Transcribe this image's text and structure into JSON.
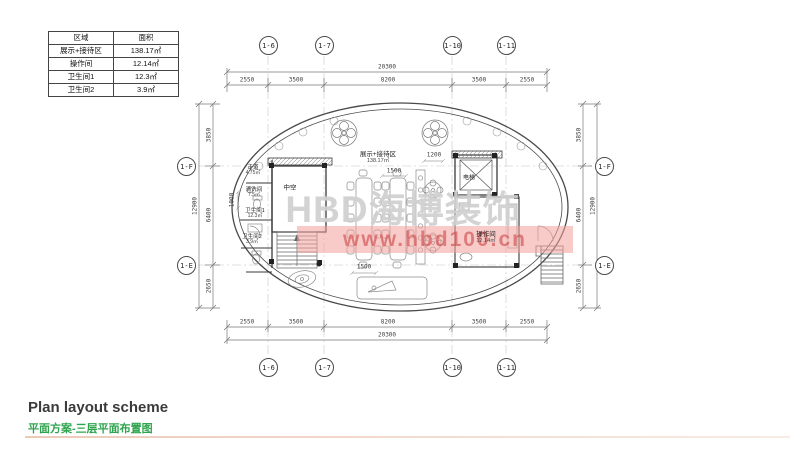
{
  "area_table": {
    "headers": [
      "区域",
      "面积"
    ],
    "rows": [
      {
        "name": "展示+接待区",
        "area": "138.17㎡"
      },
      {
        "name": "操作间",
        "area": "12.14㎡"
      },
      {
        "name": "卫生间1",
        "area": "12.3㎡"
      },
      {
        "name": "卫生间2",
        "area": "3.9㎡"
      }
    ]
  },
  "grid_bubbles": {
    "top": [
      "1-6",
      "1-7",
      "1-10",
      "1-11"
    ],
    "bottom": [
      "1-6",
      "1-7",
      "1-10",
      "1-11"
    ],
    "left": [
      "1-F",
      "1-E"
    ],
    "right": [
      "1-F",
      "1-E"
    ]
  },
  "dimensions": {
    "top_total": "20300",
    "top_chain": [
      "2550",
      "3500",
      "8200",
      "3500",
      "2550"
    ],
    "bottom_chain": [
      "2550",
      "3500",
      "8200",
      "3500",
      "2550"
    ],
    "bottom_total": "20300",
    "left_chain": [
      "3850",
      "6400",
      "2650"
    ],
    "left_total": "12900",
    "right_chain": [
      "3850",
      "6400",
      "2650"
    ],
    "right_total": "12900",
    "interior": {
      "table_top": "1500",
      "table_bottom": "1500",
      "elevator_front": "1200",
      "left_bay": "1000"
    }
  },
  "rooms": {
    "exhibition": {
      "name": "展示+接待区",
      "area": "138.17㎡"
    },
    "void": {
      "name": "中空"
    },
    "elevator": {
      "name": "电梯"
    },
    "operation": {
      "name": "操作间",
      "area": "12.14㎡"
    },
    "corridor": {
      "name": "走道",
      "area": "4.75㎡"
    },
    "cleaning": {
      "name": "清洗间",
      "area": "7.5㎡"
    },
    "toilet1": {
      "name": "卫生间1",
      "area": "12.3㎡"
    },
    "toilet2": {
      "name": "卫生间2",
      "area": "3.9㎡"
    }
  },
  "watermark": {
    "brand": "HBD海博装饰",
    "url": "www.hbd100.cn"
  },
  "footer": {
    "title_en": "Plan layout scheme",
    "title_zh": "平面方案-三层平面布置图"
  },
  "colors": {
    "title_green": "#2ea44f",
    "watermark_red": "#cd4646",
    "divider": "#eccab8"
  }
}
